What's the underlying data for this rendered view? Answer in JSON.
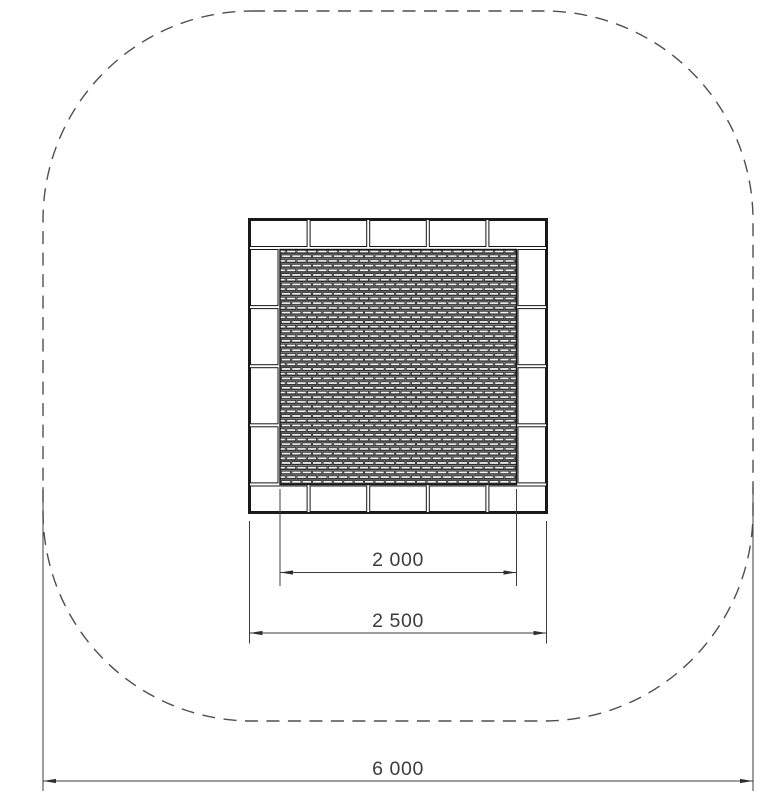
{
  "dimensions": {
    "mat": {
      "label": "2 000"
    },
    "frame": {
      "label": "2 500"
    },
    "safety_zone": {
      "label": "6 000"
    }
  },
  "colors": {
    "outline": "#1a1a1a",
    "dimension": "#3c3c3c",
    "boundary_dash": "#4f4f4f",
    "mat_tone": "#d9d9d9"
  }
}
